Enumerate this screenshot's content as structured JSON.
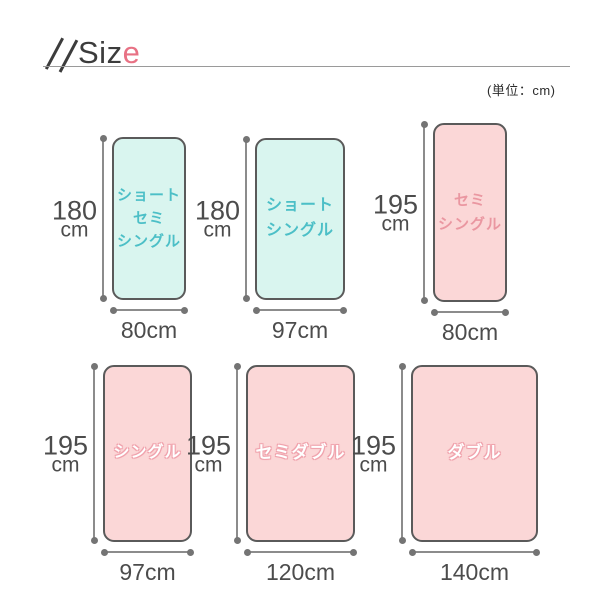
{
  "header": {
    "title_prefix": "Siz",
    "title_accent": "e",
    "unit_note": "(単位：cm)"
  },
  "colors": {
    "mint_fill": "#d9f5ef",
    "mint_text": "#4cbfc7",
    "pink_fill": "#fbd7d7",
    "pink_text": "#ea97a1",
    "accent_pink": "#e87184",
    "rect_border": "#5a5a5a",
    "dimension_line": "#8c8c8c",
    "dimension_text": "#4c4c4c"
  },
  "beds": [
    {
      "label": "ショート\nセミ\nシングル",
      "height_value": "180",
      "height_unit": "cm",
      "width_label": "80cm",
      "fill": "mint"
    },
    {
      "label": "ショート\nシングル",
      "height_value": "180",
      "height_unit": "cm",
      "width_label": "97cm",
      "fill": "mint"
    },
    {
      "label": "セミ\nシングル",
      "height_value": "195",
      "height_unit": "cm",
      "width_label": "80cm",
      "fill": "pink"
    },
    {
      "label": "シングル",
      "height_value": "195",
      "height_unit": "cm",
      "width_label": "97cm",
      "fill": "pink"
    },
    {
      "label": "セミダブル",
      "height_value": "195",
      "height_unit": "cm",
      "width_label": "120cm",
      "fill": "pink"
    },
    {
      "label": "ダブル",
      "height_value": "195",
      "height_unit": "cm",
      "width_label": "140cm",
      "fill": "pink"
    }
  ]
}
